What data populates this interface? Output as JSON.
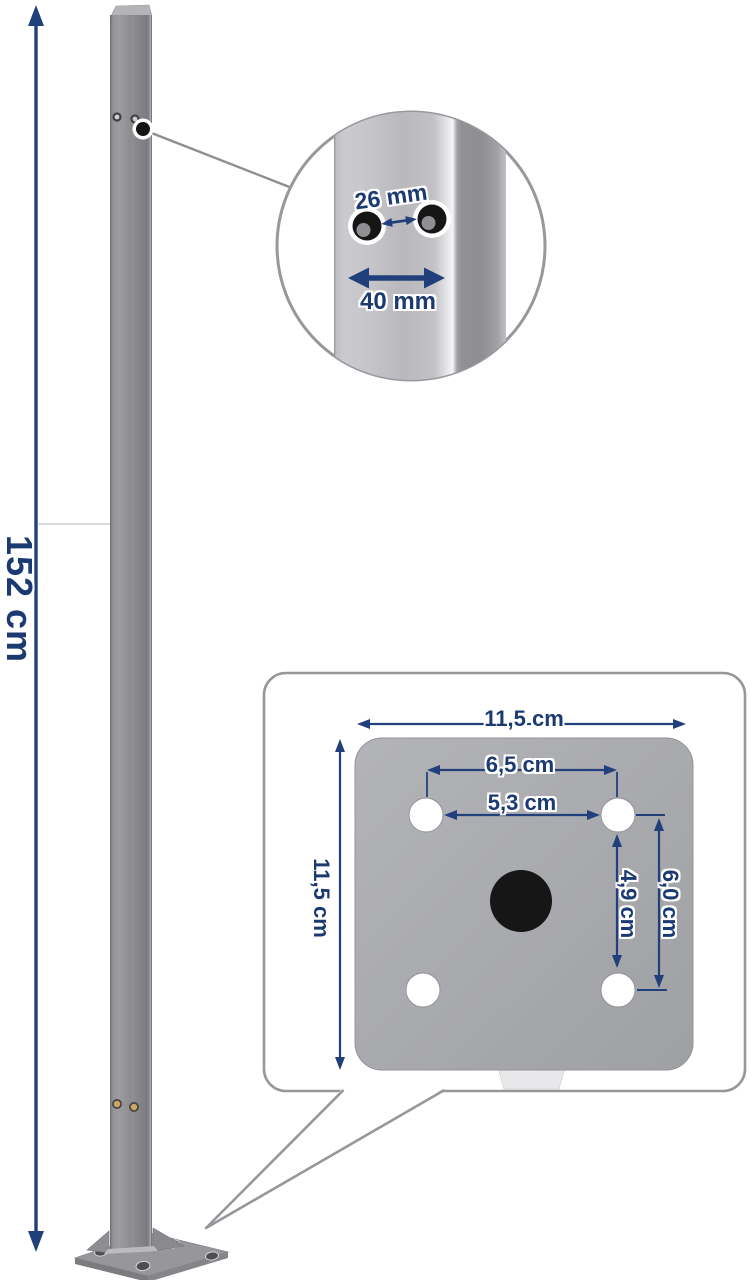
{
  "page": {
    "description": "Product dimension diagram of a gray metal fence post with base plate",
    "background": "#ffffff"
  },
  "colors": {
    "dimension_navy": "#21407b",
    "label_navy": "#1c3a72",
    "callout_border": "#97979b",
    "post_gray": "#8c8c90",
    "plate_gray": "#a9a9ad"
  },
  "height_dimension": {
    "label": "152 cm"
  },
  "detail_callout": {
    "hole_spacing_label": "26 mm",
    "post_width_label": "40 mm"
  },
  "base_plate_callout": {
    "plate_width_label": "11,5 cm",
    "plate_height_label": "11,5 cm",
    "hole_spacing_outer_label": "6,5 cm",
    "hole_spacing_inner_label": "5,3 cm",
    "hole_offset_vertical_label": "4,9 cm",
    "hole_spacing_vertical_label": "6,0 cm"
  }
}
